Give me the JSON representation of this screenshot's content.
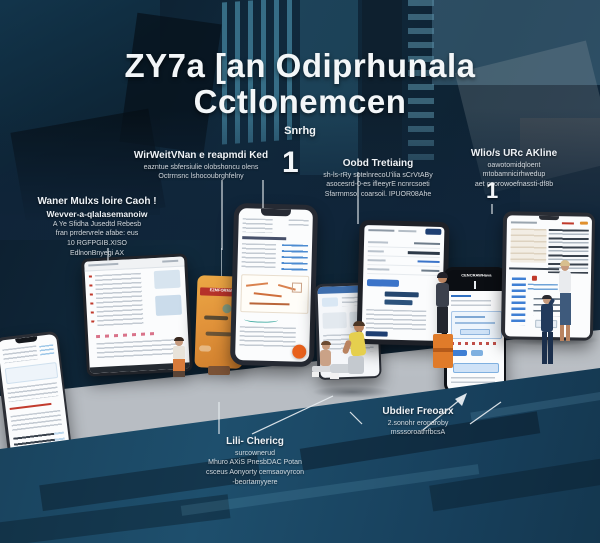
{
  "title": {
    "line1": "ZY7a [an Odiprhunala",
    "line2": "Cctlonemcen",
    "subtitle": "Snrhg"
  },
  "callouts": {
    "left": {
      "title": "Waner Mulxs loire Caoh !",
      "subtitle": "Wevver-a-qlalasemanoiw",
      "lines": [
        "A Ye Sfidha Jusedtd Rebesb",
        "fran prrdervrele afabe: eus",
        "10 RGFPGIB.XISO",
        "EdlnonBnyegi AX"
      ]
    },
    "keyed": {
      "title": "WirWeitVNan e reapmdi Ked",
      "lines": [
        "eazntue sbfersiulie olobshoncu olens",
        "Octrrnsnc lshocoubrghfelny"
      ],
      "number": "1"
    },
    "oobd": {
      "title": "Oobd Tretiaing",
      "lines": [
        "sh-ls-rRy sotelnrecoU'ilia sCrVtABy",
        "asocesrd-0-es ifleeyrE ncnrcsoeti",
        "Sfarrnmso, coarsoil. IPUOR08Ahe"
      ]
    },
    "right": {
      "title": "Wlio/s URc AKline",
      "lines": [
        "oawotomidqloent",
        "mtobamnicirhwedup",
        "aet cnorowoefnassti-df8b"
      ],
      "number": "1"
    },
    "bottom_center": {
      "title": "Lili- Chericg",
      "lines": [
        "surcownerud",
        "Mhuro AXiS PnesbDAC Potan",
        "csceus Aonyorty cemsaovyrcon",
        "-beortamyyere"
      ]
    },
    "bottom_right": {
      "title": "Ubdier Freoarx",
      "lines": [
        "2.sonohr eronaroby",
        "msssoroatrrfbcsA"
      ]
    }
  },
  "devices": {
    "orange_label": "EZMFORMA",
    "right_phone_header": "CENCRAWHava"
  },
  "colors": {
    "accent_orange": "#e8611c",
    "device_orange": "#e2943b",
    "label_red": "#b5322a",
    "ui_blue": "#3b74c9",
    "bg_navy": "#10293c",
    "floor_gray": "#c8ccd0",
    "slab_teal": "#1d4a63"
  }
}
